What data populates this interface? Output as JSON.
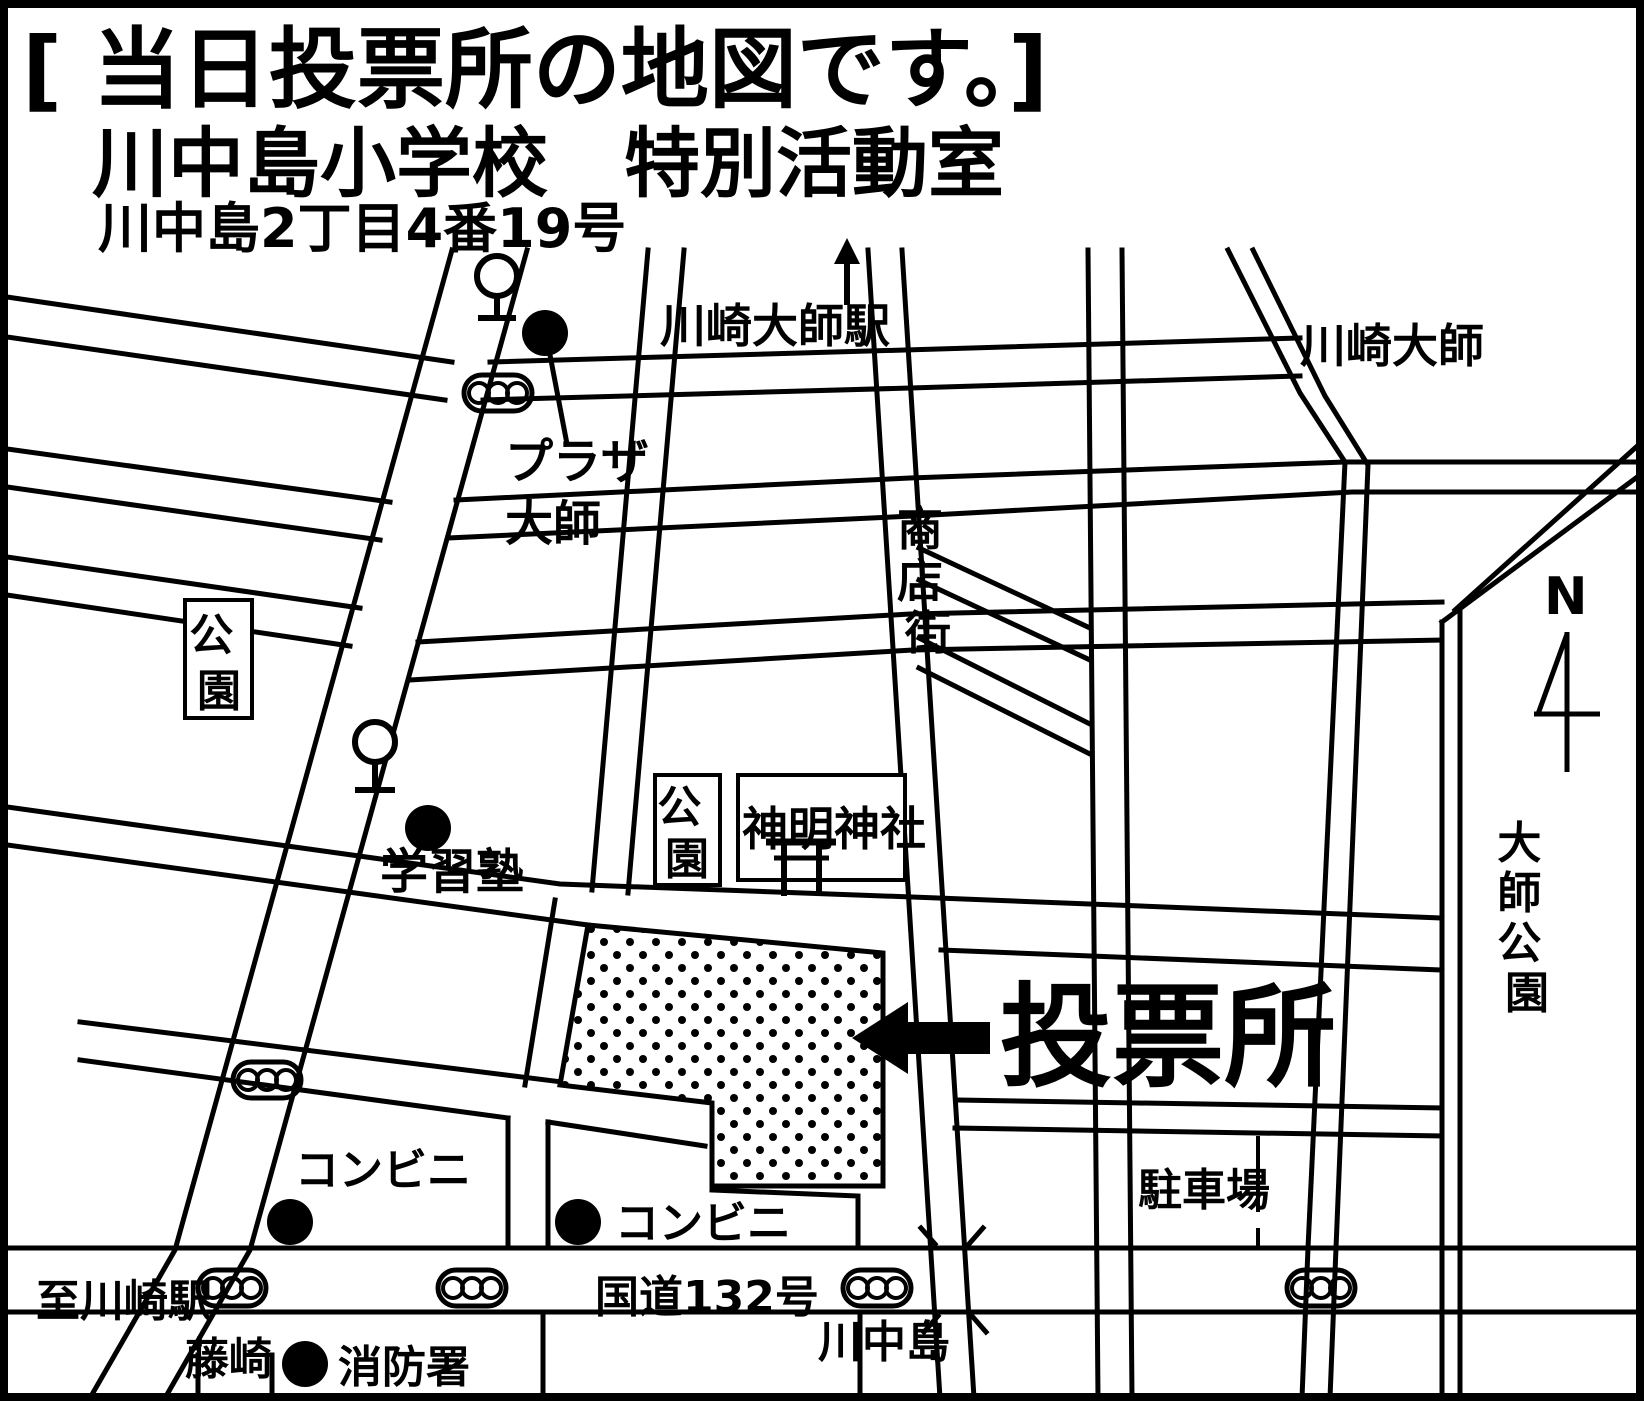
{
  "title": {
    "line1": "[ 当日投票所の地図です。]",
    "line2": "川中島小学校　特別活動室",
    "line3": "川中島2丁目4番19号"
  },
  "map": {
    "labels": {
      "station": "川崎大師駅",
      "daishi_area": "川崎大師",
      "plaza_line1": "プラザ",
      "plaza_line2": "大師",
      "shotengai_chars": [
        "商",
        "店",
        "街"
      ],
      "park1_chars": [
        "公",
        "園"
      ],
      "park2_chars": [
        "公",
        "園"
      ],
      "shrine": "神明神社",
      "cram_school": "学習塾",
      "polling_place": "投票所",
      "convenience1": "コンビニ",
      "convenience2": "コンビニ",
      "to_kawasaki_station": "至川崎駅",
      "fujisaki": "藤崎",
      "fire_station": "消防署",
      "route132": "国道132号",
      "kawanakajima": "川中島",
      "parking": "駐車場",
      "daishi_park_chars": [
        "大",
        "師",
        "公",
        "園"
      ],
      "north": "N"
    },
    "icons": {
      "traffic_light": "three-circle-signal",
      "station_symbol": "pole-with-circle",
      "poi_dot": "filled-circle-marker",
      "torii": "shrine-gate",
      "compass": "north-arrow",
      "station_direction": "up-arrow",
      "polling_arrow": "left-arrow"
    },
    "colors": {
      "ink": "#000000",
      "background": "#ffffff"
    }
  }
}
